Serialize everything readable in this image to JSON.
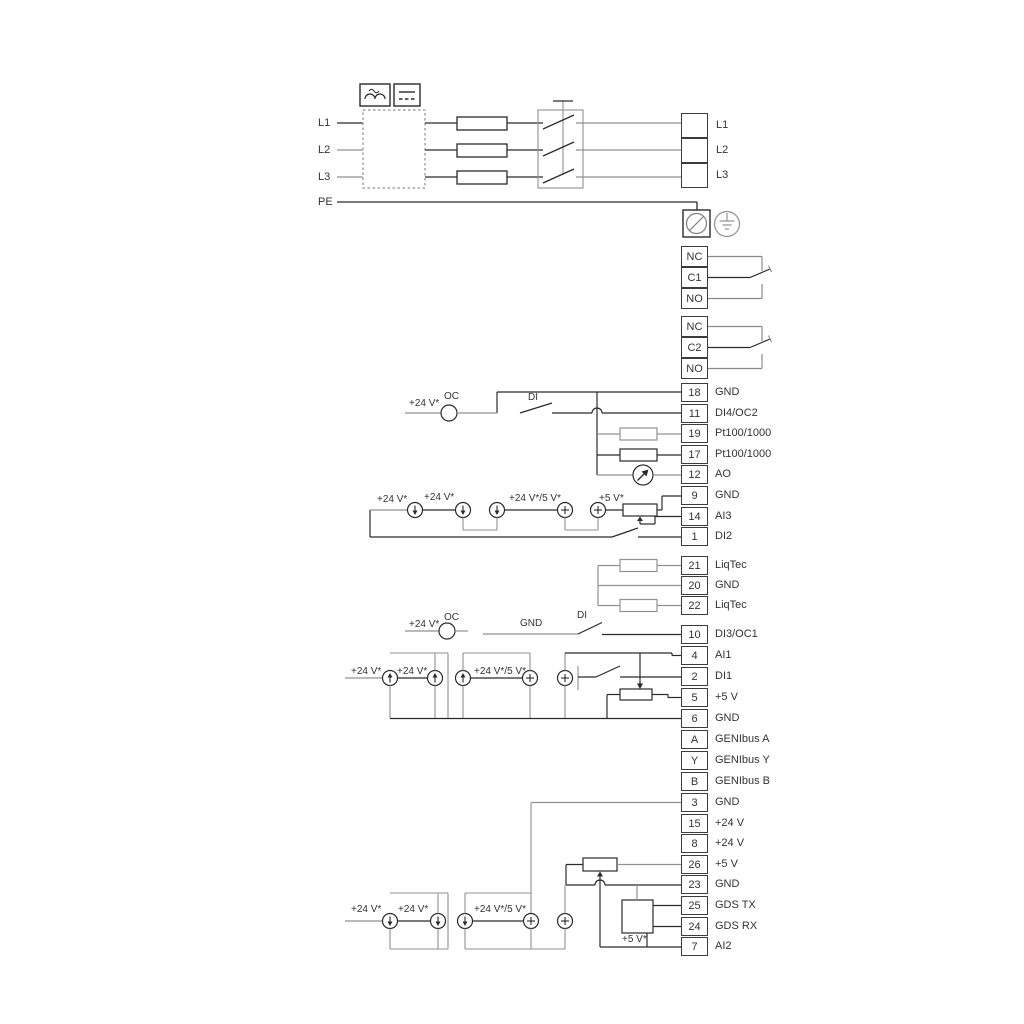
{
  "colors": {
    "line_dark": "#2a2a2a",
    "line_gray": "#919191",
    "background": "#ffffff",
    "text": "#333333"
  },
  "power": {
    "inputs": [
      "L1",
      "L2",
      "L3",
      "PE"
    ],
    "output_terminals": [
      "L1",
      "L2",
      "L3"
    ]
  },
  "relays": {
    "relay1": [
      "NC",
      "C1",
      "NO"
    ],
    "relay2": [
      "NC",
      "C2",
      "NO"
    ]
  },
  "terminal_groups": {
    "group1": [
      {
        "num": "18",
        "label": "GND"
      },
      {
        "num": "11",
        "label": "DI4/OC2"
      },
      {
        "num": "19",
        "label": "Pt100/1000"
      },
      {
        "num": "17",
        "label": "Pt100/1000"
      },
      {
        "num": "12",
        "label": "AO"
      },
      {
        "num": "9",
        "label": "GND"
      },
      {
        "num": "14",
        "label": "AI3"
      },
      {
        "num": "1",
        "label": "DI2"
      }
    ],
    "group2": [
      {
        "num": "21",
        "label": "LiqTec"
      },
      {
        "num": "20",
        "label": "GND"
      },
      {
        "num": "22",
        "label": "LiqTec"
      }
    ],
    "group3": [
      {
        "num": "10",
        "label": "DI3/OC1"
      },
      {
        "num": "4",
        "label": "AI1"
      },
      {
        "num": "2",
        "label": "DI1"
      },
      {
        "num": "5",
        "label": "+5 V"
      },
      {
        "num": "6",
        "label": "GND"
      },
      {
        "num": "A",
        "label": "GENIbus A"
      },
      {
        "num": "Y",
        "label": "GENIbus Y"
      },
      {
        "num": "B",
        "label": "GENIbus B"
      }
    ],
    "group4": [
      {
        "num": "3",
        "label": "GND"
      },
      {
        "num": "15",
        "label": "+24 V"
      },
      {
        "num": "8",
        "label": "+24 V"
      },
      {
        "num": "26",
        "label": "+5 V"
      },
      {
        "num": "23",
        "label": "GND"
      },
      {
        "num": "25",
        "label": "GDS TX"
      },
      {
        "num": "24",
        "label": "GDS RX"
      },
      {
        "num": "7",
        "label": "AI2"
      }
    ]
  },
  "wire_labels": {
    "v24": "+24 V*",
    "v24_5": "+24 V*/5 V*",
    "v5": "+5 V*",
    "oc": "OC",
    "di": "DI",
    "gnd": "GND"
  }
}
